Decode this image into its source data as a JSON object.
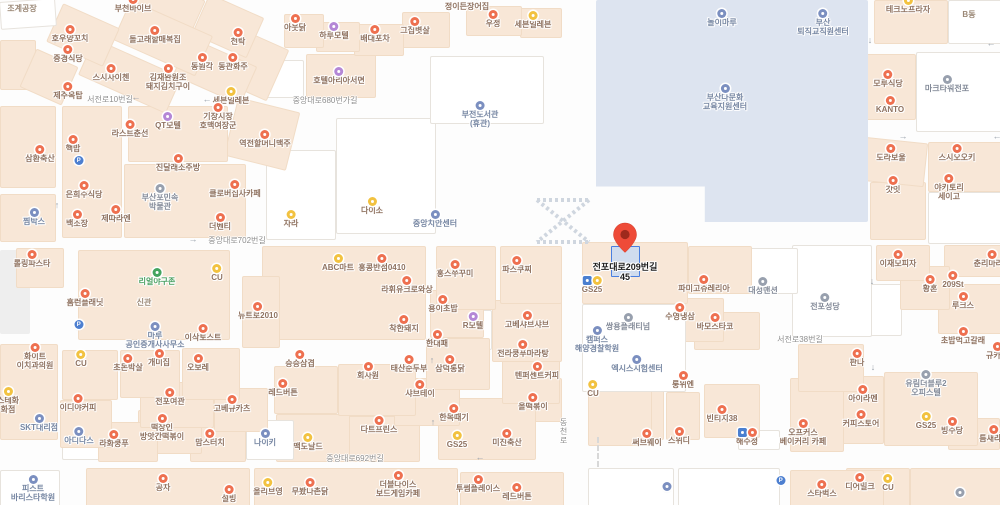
{
  "map": {
    "pin": {
      "label_line1": "전포대로209번길",
      "label_line2": "45"
    },
    "colors": {
      "food_icon": "#ee7050",
      "store_icon": "#f2c240",
      "motel_icon": "#b487d6",
      "public_icon": "#7b8fc0",
      "gray_icon": "#98a0ae",
      "green_icon": "#43a45f",
      "parking_icon": "#4d7fd0",
      "busstop_icon": "#4a7fd0",
      "pin_red": "#ee4b38",
      "highlight_blue": "#4a7fe0",
      "block_peach": "#f8e7d7",
      "campus_blue": "#dde4f0",
      "food_text": "#8f7260",
      "public_text": "#7787a3",
      "gray_text": "#848b99",
      "green_text": "#4aa061",
      "plain_text": "#9b8876",
      "road_text": "#8e8e8e"
    },
    "road_labels": [
      {
        "text": "서전로10번길",
        "x": 110,
        "y": 94
      },
      {
        "text": "중앙대로680번가길",
        "x": 325,
        "y": 95
      },
      {
        "text": "중앙대로702번길",
        "x": 237,
        "y": 235
      },
      {
        "text": "중앙대로692번길",
        "x": 355,
        "y": 453
      },
      {
        "text": "서전로38번길",
        "x": 800,
        "y": 334
      },
      {
        "text": "동천로",
        "x": 558,
        "y": 418,
        "vertical": true
      }
    ],
    "arrows": [
      {
        "g": "↑",
        "x": 55,
        "y": 40
      },
      {
        "g": "←",
        "x": 136,
        "y": 97
      },
      {
        "g": "←",
        "x": 207,
        "y": 99
      },
      {
        "g": "→",
        "x": 193,
        "y": 239
      },
      {
        "g": "←",
        "x": 480,
        "y": 457
      },
      {
        "g": "↑",
        "x": 57,
        "y": 205
      },
      {
        "g": "↓",
        "x": 870,
        "y": 40
      },
      {
        "g": "←",
        "x": 991,
        "y": 43
      },
      {
        "g": "→",
        "x": 903,
        "y": 136
      },
      {
        "g": "↓",
        "x": 872,
        "y": 281
      },
      {
        "g": "↓",
        "x": 873,
        "y": 367
      },
      {
        "g": "↑",
        "x": 432,
        "y": 360
      },
      {
        "g": "↑",
        "x": 433,
        "y": 422
      },
      {
        "g": "←",
        "x": 997,
        "y": 136
      }
    ],
    "places": [
      {
        "lines": [
          "조계공장"
        ],
        "x": 22,
        "y": 6,
        "t": "plain"
      },
      {
        "lines": [
          "부천바이브"
        ],
        "x": 133,
        "y": 7,
        "t": "food"
      },
      {
        "lines": [
          "호우양꼬치"
        ],
        "x": 70,
        "y": 37,
        "t": "food"
      },
      {
        "lines": [
          "돌고래할매복집"
        ],
        "x": 155,
        "y": 38,
        "t": "food"
      },
      {
        "lines": [
          "천탁"
        ],
        "x": 238,
        "y": 40,
        "t": "food"
      },
      {
        "lines": [
          "중경식당"
        ],
        "x": 68,
        "y": 57,
        "t": "food"
      },
      {
        "lines": [
          "동원각"
        ],
        "x": 202,
        "y": 65,
        "t": "food"
      },
      {
        "lines": [
          "동관화주"
        ],
        "x": 233,
        "y": 65,
        "t": "food"
      },
      {
        "lines": [
          "스시사이첸"
        ],
        "x": 111,
        "y": 76,
        "t": "food"
      },
      {
        "lines": [
          "김재완원조",
          "돼지김치구이"
        ],
        "x": 168,
        "y": 76,
        "t": "food"
      },
      {
        "lines": [
          "제주옥탑"
        ],
        "x": 68,
        "y": 94,
        "t": "food"
      },
      {
        "lines": [
          "세븐일레븐"
        ],
        "x": 231,
        "y": 99,
        "t": "store"
      },
      {
        "lines": [
          "정이든장어집"
        ],
        "x": 467,
        "y": 4,
        "t": "food",
        "ni": true
      },
      {
        "lines": [
          "아웃닭"
        ],
        "x": 295,
        "y": 26,
        "t": "food"
      },
      {
        "lines": [
          "하루모텔"
        ],
        "x": 334,
        "y": 34,
        "t": "motel"
      },
      {
        "lines": [
          "배대포차"
        ],
        "x": 375,
        "y": 37,
        "t": "food"
      },
      {
        "lines": [
          "그집볏살"
        ],
        "x": 415,
        "y": 29,
        "t": "food"
      },
      {
        "lines": [
          "우정"
        ],
        "x": 493,
        "y": 22,
        "t": "food"
      },
      {
        "lines": [
          "세븐일레븐"
        ],
        "x": 533,
        "y": 23,
        "t": "store"
      },
      {
        "lines": [
          "호텔아리아서면"
        ],
        "x": 339,
        "y": 79,
        "t": "motel"
      },
      {
        "lines": [
          "부전도서관",
          "(휴관)"
        ],
        "x": 480,
        "y": 113,
        "t": "public"
      },
      {
        "lines": [
          "QT모텔"
        ],
        "x": 168,
        "y": 124,
        "t": "motel"
      },
      {
        "lines": [
          "라스트춘선"
        ],
        "x": 130,
        "y": 132,
        "t": "food"
      },
      {
        "lines": [
          "기장시장",
          "호맥여장군"
        ],
        "x": 218,
        "y": 115,
        "t": "food"
      },
      {
        "lines": [
          "역전할머니맥주"
        ],
        "x": 265,
        "y": 142,
        "t": "food"
      },
      {
        "lines": [
          "핵밥"
        ],
        "x": 73,
        "y": 147,
        "t": "food"
      },
      {
        "lines": [
          "삼환축산"
        ],
        "x": 40,
        "y": 157,
        "t": "food"
      },
      {
        "lines": [
          "진달래소주방"
        ],
        "x": 178,
        "y": 166,
        "t": "food"
      },
      {
        "lines": [
          "은희수식당"
        ],
        "x": 84,
        "y": 193,
        "t": "food"
      },
      {
        "lines": [
          "부산포민속",
          "박물관"
        ],
        "x": 160,
        "y": 196,
        "t": "gray"
      },
      {
        "lines": [
          "클로버집사카페"
        ],
        "x": 235,
        "y": 192,
        "t": "food"
      },
      {
        "lines": [
          "찜박스"
        ],
        "x": 34,
        "y": 220,
        "t": "public"
      },
      {
        "lines": [
          "제따라엔"
        ],
        "x": 116,
        "y": 217,
        "t": "food"
      },
      {
        "lines": [
          "백소장"
        ],
        "x": 77,
        "y": 222,
        "t": "food"
      },
      {
        "lines": [
          "더벤티"
        ],
        "x": 220,
        "y": 225,
        "t": "food"
      },
      {
        "lines": [
          "자라"
        ],
        "x": 291,
        "y": 222,
        "t": "store"
      },
      {
        "lines": [
          "다이소"
        ],
        "x": 372,
        "y": 209,
        "t": "store"
      },
      {
        "lines": [
          "중앙치안센터"
        ],
        "x": 435,
        "y": 222,
        "t": "public"
      },
      {
        "lines": [
          "놀이마루"
        ],
        "x": 722,
        "y": 21,
        "t": "public"
      },
      {
        "lines": [
          "부산",
          "퇴직교직원센터"
        ],
        "x": 823,
        "y": 21,
        "t": "public"
      },
      {
        "lines": [
          "부산다문화",
          "교육지원센터"
        ],
        "x": 725,
        "y": 96,
        "t": "public"
      },
      {
        "lines": [
          "테크노프라자"
        ],
        "x": 908,
        "y": 8,
        "t": "store"
      },
      {
        "lines": [
          "B동"
        ],
        "x": 969,
        "y": 12,
        "t": "plain"
      },
      {
        "lines": [
          "모루식당"
        ],
        "x": 888,
        "y": 82,
        "t": "food"
      },
      {
        "lines": [
          "마크타워전포"
        ],
        "x": 947,
        "y": 87,
        "t": "gray"
      },
      {
        "lines": [
          "KANTO"
        ],
        "x": 890,
        "y": 108,
        "t": "food"
      },
      {
        "lines": [
          "도라보울"
        ],
        "x": 891,
        "y": 156,
        "t": "food"
      },
      {
        "lines": [
          "스시오오키"
        ],
        "x": 957,
        "y": 156,
        "t": "food"
      },
      {
        "lines": [
          "갓잇"
        ],
        "x": 893,
        "y": 188,
        "t": "food"
      },
      {
        "lines": [
          "야키토리",
          "세이고"
        ],
        "x": 949,
        "y": 186,
        "t": "food"
      },
      {
        "lines": [
          "롤링파스타"
        ],
        "x": 32,
        "y": 262,
        "t": "food"
      },
      {
        "lines": [
          "리얼야구존"
        ],
        "x": 157,
        "y": 280,
        "t": "green"
      },
      {
        "lines": [
          "CU"
        ],
        "x": 217,
        "y": 276,
        "t": "store"
      },
      {
        "lines": [
          "홈런플래닛"
        ],
        "x": 85,
        "y": 301,
        "t": "food"
      },
      {
        "lines": [
          "신관"
        ],
        "x": 144,
        "y": 300,
        "t": "plain"
      },
      {
        "lines": [
          "뉴트로2010"
        ],
        "x": 258,
        "y": 314,
        "t": "food"
      },
      {
        "lines": [
          "마루",
          "공인중개사사무소"
        ],
        "x": 155,
        "y": 334,
        "t": "public"
      },
      {
        "lines": [
          "이삭토스트"
        ],
        "x": 203,
        "y": 336,
        "t": "food"
      },
      {
        "lines": [
          "ABC마트"
        ],
        "x": 338,
        "y": 266,
        "t": "store"
      },
      {
        "lines": [
          "홍콩반점0410"
        ],
        "x": 382,
        "y": 266,
        "t": "food"
      },
      {
        "lines": [
          "라휘유크로와상"
        ],
        "x": 407,
        "y": 288,
        "t": "food"
      },
      {
        "lines": [
          "홍스쭈꾸미"
        ],
        "x": 455,
        "y": 272,
        "t": "food"
      },
      {
        "lines": [
          "파스쿠찌"
        ],
        "x": 517,
        "y": 268,
        "t": "food"
      },
      {
        "lines": [
          "용이초밥"
        ],
        "x": 443,
        "y": 307,
        "t": "food"
      },
      {
        "lines": [
          "R모텔"
        ],
        "x": 473,
        "y": 324,
        "t": "motel"
      },
      {
        "lines": [
          "고베샤브샤브"
        ],
        "x": 527,
        "y": 323,
        "t": "food"
      },
      {
        "lines": [
          "착한돼지"
        ],
        "x": 404,
        "y": 327,
        "t": "food"
      },
      {
        "lines": [
          "한대패"
        ],
        "x": 437,
        "y": 342,
        "t": "food"
      },
      {
        "lines": [
          "전라쿵푸마라탕"
        ],
        "x": 523,
        "y": 352,
        "t": "food"
      },
      {
        "lines": [
          "승승삼겹"
        ],
        "x": 300,
        "y": 362,
        "t": "food"
      },
      {
        "lines": [
          "회사원"
        ],
        "x": 368,
        "y": 374,
        "t": "food"
      },
      {
        "lines": [
          "태산순두부"
        ],
        "x": 409,
        "y": 367,
        "t": "food"
      },
      {
        "lines": [
          "삼덕통닭"
        ],
        "x": 450,
        "y": 367,
        "t": "food"
      },
      {
        "lines": [
          "텐퍼센트커피"
        ],
        "x": 537,
        "y": 374,
        "t": "food"
      },
      {
        "lines": [
          "GS25"
        ],
        "x": 592,
        "y": 288,
        "t": "store",
        "icons": [
          "busstop",
          "store"
        ]
      },
      {
        "lines": [
          "파미고쥬레리아"
        ],
        "x": 704,
        "y": 287,
        "t": "food"
      },
      {
        "lines": [
          "대성맨션"
        ],
        "x": 763,
        "y": 289,
        "t": "gray"
      },
      {
        "lines": [
          "수영냉삼"
        ],
        "x": 680,
        "y": 315,
        "t": "food"
      },
      {
        "lines": [
          "바모스타코"
        ],
        "x": 715,
        "y": 325,
        "t": "food"
      },
      {
        "lines": [
          "쌍용플래티넘"
        ],
        "x": 628,
        "y": 325,
        "t": "gray"
      },
      {
        "lines": [
          "캠퍼스",
          "해양경찰학원"
        ],
        "x": 597,
        "y": 338,
        "t": "public"
      },
      {
        "lines": [
          "엑시스시험센터"
        ],
        "x": 637,
        "y": 367,
        "t": "public"
      },
      {
        "lines": [
          "룽위엔"
        ],
        "x": 683,
        "y": 383,
        "t": "food"
      },
      {
        "lines": [
          "전포성당"
        ],
        "x": 825,
        "y": 305,
        "t": "gray"
      },
      {
        "lines": [
          "이재모피자"
        ],
        "x": 898,
        "y": 262,
        "t": "food"
      },
      {
        "lines": [
          "춘리마라탕"
        ],
        "x": 992,
        "y": 262,
        "t": "food"
      },
      {
        "lines": [
          "209St"
        ],
        "x": 953,
        "y": 283,
        "t": "food"
      },
      {
        "lines": [
          "황혼"
        ],
        "x": 930,
        "y": 287,
        "t": "food"
      },
      {
        "lines": [
          "루크스"
        ],
        "x": 963,
        "y": 304,
        "t": "food"
      },
      {
        "lines": [
          "초밥먹고갈래"
        ],
        "x": 963,
        "y": 339,
        "t": "food"
      },
      {
        "lines": [
          "규카츠"
        ],
        "x": 997,
        "y": 354,
        "t": "food"
      },
      {
        "lines": [
          "판나"
        ],
        "x": 857,
        "y": 361,
        "t": "food"
      },
      {
        "lines": [
          "화이트",
          "이치과의원"
        ],
        "x": 35,
        "y": 355,
        "t": "food"
      },
      {
        "lines": [
          "CU"
        ],
        "x": 81,
        "y": 362,
        "t": "store"
      },
      {
        "lines": [
          "초돈박살"
        ],
        "x": 128,
        "y": 366,
        "t": "food"
      },
      {
        "lines": [
          "개미집"
        ],
        "x": 159,
        "y": 361,
        "t": "food"
      },
      {
        "lines": [
          "오보레"
        ],
        "x": 198,
        "y": 366,
        "t": "food"
      },
      {
        "lines": [
          "스테화",
          "화점"
        ],
        "x": 8,
        "y": 399,
        "t": "store"
      },
      {
        "lines": [
          "SKT대리점"
        ],
        "x": 39,
        "y": 426,
        "t": "public"
      },
      {
        "lines": [
          "이디야커피"
        ],
        "x": 78,
        "y": 406,
        "t": "food"
      },
      {
        "lines": [
          "전포여관"
        ],
        "x": 170,
        "y": 400,
        "t": "food"
      },
      {
        "lines": [
          "고베규카츠"
        ],
        "x": 232,
        "y": 407,
        "t": "food"
      },
      {
        "lines": [
          "아디다스"
        ],
        "x": 79,
        "y": 439,
        "t": "public"
      },
      {
        "lines": [
          "라화쿵푸"
        ],
        "x": 114,
        "y": 442,
        "t": "food"
      },
      {
        "lines": [
          "떡장인",
          "방앗간떡볶이"
        ],
        "x": 162,
        "y": 426,
        "t": "food"
      },
      {
        "lines": [
          "맘스터치"
        ],
        "x": 210,
        "y": 441,
        "t": "food"
      },
      {
        "lines": [
          "나이키"
        ],
        "x": 265,
        "y": 441,
        "t": "public"
      },
      {
        "lines": [
          "레드버튼"
        ],
        "x": 283,
        "y": 391,
        "t": "food"
      },
      {
        "lines": [
          "샤브테이"
        ],
        "x": 420,
        "y": 392,
        "t": "food"
      },
      {
        "lines": [
          "다트프린스"
        ],
        "x": 379,
        "y": 428,
        "t": "food"
      },
      {
        "lines": [
          "맥도날드"
        ],
        "x": 308,
        "y": 445,
        "t": "store"
      },
      {
        "lines": [
          "한목때기"
        ],
        "x": 454,
        "y": 416,
        "t": "food"
      },
      {
        "lines": [
          "GS25"
        ],
        "x": 457,
        "y": 443,
        "t": "store"
      },
      {
        "lines": [
          "미진축산"
        ],
        "x": 507,
        "y": 441,
        "t": "food"
      },
      {
        "lines": [
          "올떡볶이"
        ],
        "x": 533,
        "y": 405,
        "t": "food"
      },
      {
        "lines": [
          "써브웨이"
        ],
        "x": 647,
        "y": 441,
        "t": "food"
      },
      {
        "lines": [
          "스위디"
        ],
        "x": 679,
        "y": 439,
        "t": "food"
      },
      {
        "lines": [
          "빈티지38"
        ],
        "x": 722,
        "y": 417,
        "t": "food"
      },
      {
        "lines": [
          "해수정"
        ],
        "x": 747,
        "y": 440,
        "t": "food",
        "icons": [
          "busstop",
          "food"
        ]
      },
      {
        "lines": [
          "CU"
        ],
        "x": 593,
        "y": 392,
        "t": "store"
      },
      {
        "lines": [
          "피스트",
          "바리스타학원"
        ],
        "x": 33,
        "y": 487,
        "t": "public"
      },
      {
        "lines": [
          "공차"
        ],
        "x": 163,
        "y": 486,
        "t": "food"
      },
      {
        "lines": [
          "설빙"
        ],
        "x": 229,
        "y": 497,
        "t": "food"
      },
      {
        "lines": [
          "올리브영"
        ],
        "x": 268,
        "y": 490,
        "t": "store"
      },
      {
        "lines": [
          "무봤나촌닭"
        ],
        "x": 310,
        "y": 490,
        "t": "food"
      },
      {
        "lines": [
          "더블다이스",
          "보드게임카페"
        ],
        "x": 398,
        "y": 483,
        "t": "food"
      },
      {
        "lines": [
          "투썸플레이스"
        ],
        "x": 478,
        "y": 487,
        "t": "food"
      },
      {
        "lines": [
          "레드버튼"
        ],
        "x": 517,
        "y": 495,
        "t": "food"
      },
      {
        "lines": [
          "스타벅스"
        ],
        "x": 822,
        "y": 492,
        "t": "food"
      },
      {
        "lines": [
          "디어밀크"
        ],
        "x": 860,
        "y": 485,
        "t": "food"
      },
      {
        "lines": [
          "CU"
        ],
        "x": 888,
        "y": 486,
        "t": "store"
      },
      {
        "lines": [
          "오프커스",
          "베이커리 카페"
        ],
        "x": 803,
        "y": 431,
        "t": "food"
      },
      {
        "lines": [
          "커피스토어"
        ],
        "x": 861,
        "y": 422,
        "t": "food"
      },
      {
        "lines": [
          "아이라멘"
        ],
        "x": 863,
        "y": 397,
        "t": "food"
      },
      {
        "lines": [
          "유림더블루2",
          "오피스텔"
        ],
        "x": 926,
        "y": 382,
        "t": "gray"
      },
      {
        "lines": [
          "GS25"
        ],
        "x": 926,
        "y": 424,
        "t": "store"
      },
      {
        "lines": [
          "빙수당"
        ],
        "x": 952,
        "y": 429,
        "t": "food"
      },
      {
        "lines": [
          "틈새라면"
        ],
        "x": 994,
        "y": 437,
        "t": "food"
      },
      {
        "lines": [],
        "x": 79,
        "y": 168,
        "t": "parking"
      },
      {
        "lines": [],
        "x": 79,
        "y": 332,
        "t": "parking"
      },
      {
        "lines": [],
        "x": 781,
        "y": 488,
        "t": "parking"
      },
      {
        "lines": [],
        "x": 667,
        "y": 494,
        "t": "public"
      },
      {
        "lines": [],
        "x": 960,
        "y": 500,
        "t": "gray"
      }
    ]
  }
}
